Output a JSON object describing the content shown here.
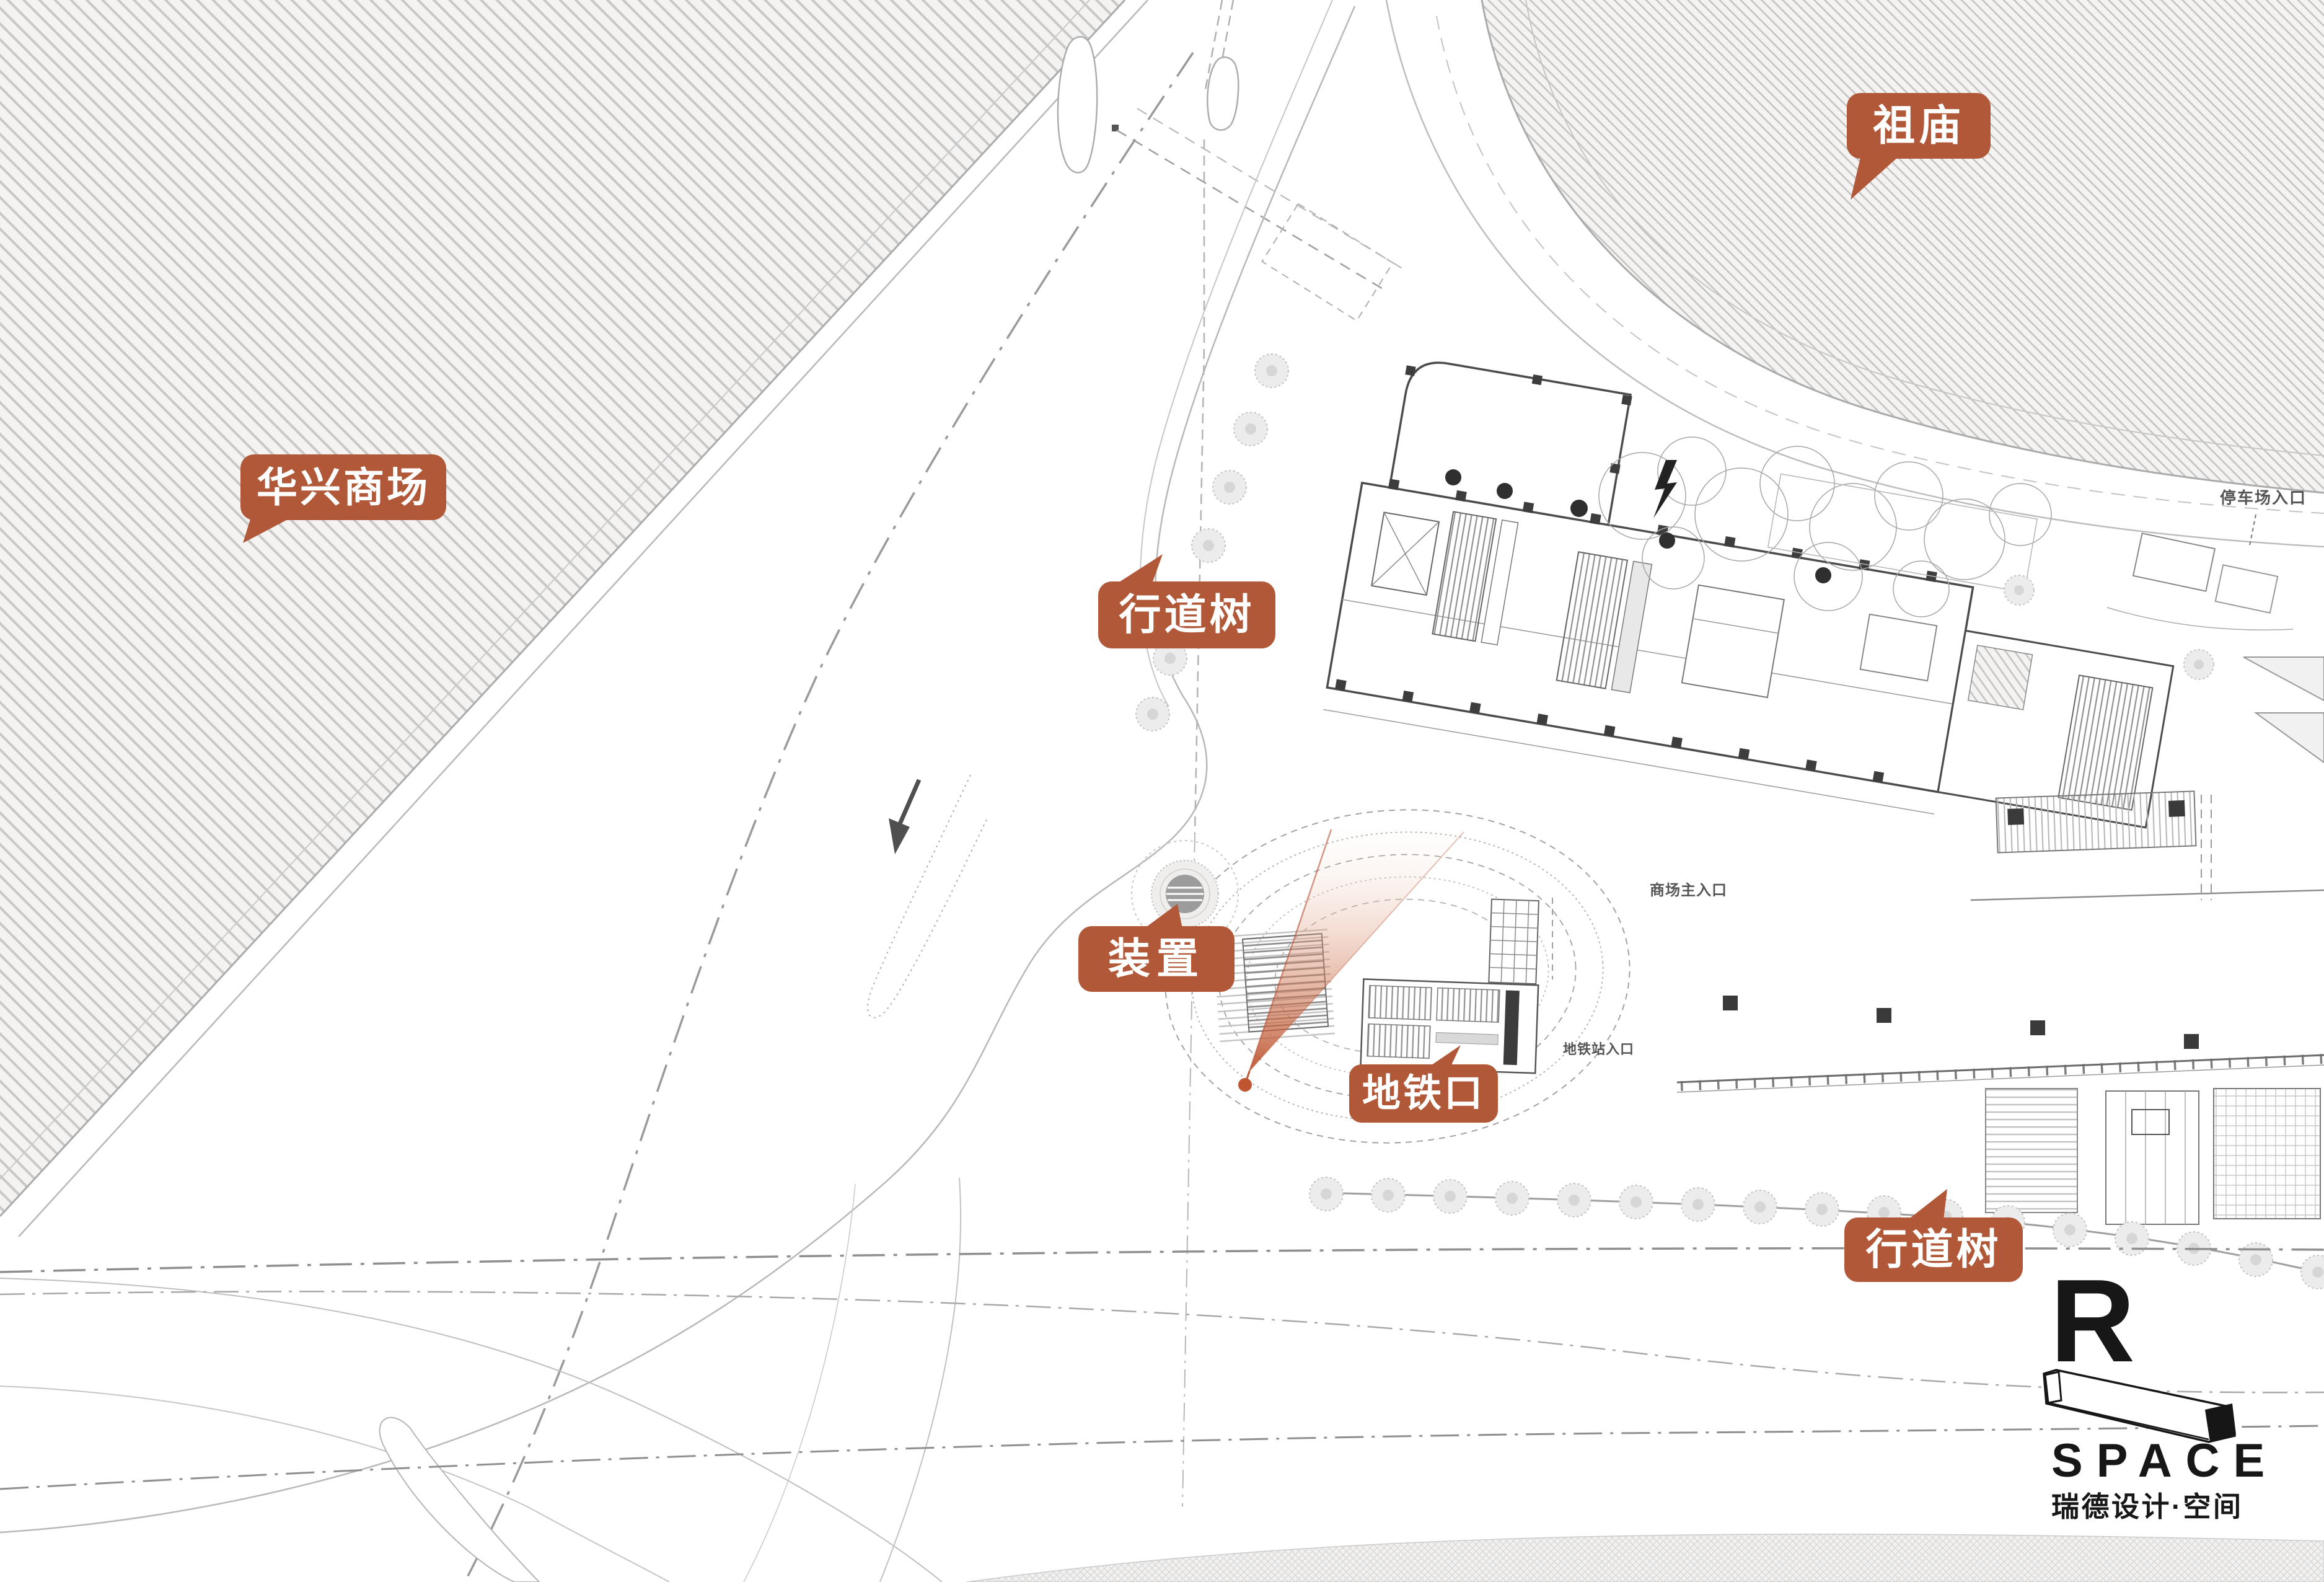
{
  "labels": {
    "zumiao": "祖庙",
    "huaxing": "华兴商场",
    "xingdaoshu_top": "行道树",
    "zhuangzhi": "装置",
    "ditiekou": "地铁口",
    "xingdaoshu_bottom": "行道树"
  },
  "plan_texts": {
    "parking_entrance": "停车场入口",
    "mall_main_entrance": "商场主入口",
    "metro_station_entrance": "地铁站入口"
  },
  "logo": {
    "letter": "R",
    "latin": "SPACE",
    "chinese": "瑞德设计·空间"
  },
  "colors": {
    "bubble": "#b15839",
    "cone": "#bc5532",
    "marker_dot": "#bf5531",
    "hatch_line": "#c8c8c8",
    "ink": "#171717"
  }
}
